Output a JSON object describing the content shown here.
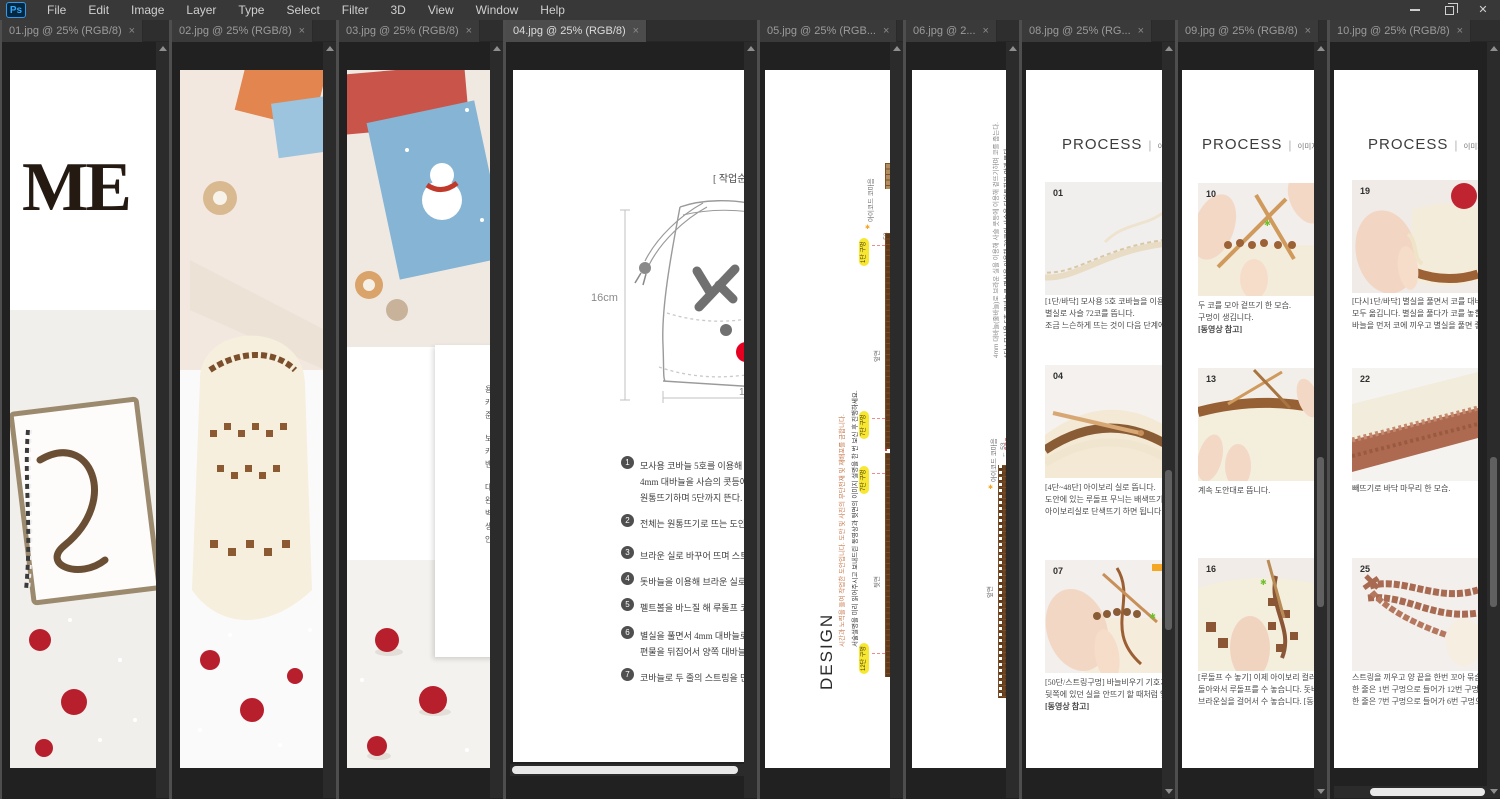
{
  "menubar": {
    "logo": "Ps",
    "items": [
      "File",
      "Edit",
      "Image",
      "Layer",
      "Type",
      "Select",
      "Filter",
      "3D",
      "View",
      "Window",
      "Help"
    ]
  },
  "window_controls": {
    "close": "✕"
  },
  "tabs": {
    "t01": "01.jpg @ 25% (RGB/8)",
    "t02": "02.jpg @ 25% (RGB/8)",
    "t03": "03.jpg @ 25% (RGB/8)",
    "t04": "04.jpg @ 25% (RGB/8)",
    "t05": "05.jpg @ 25% (RGB...",
    "t06": "06.jpg @ 2...",
    "t08": "08.jpg @ 25% (RG...",
    "t09": "09.jpg @ 25% (RGB/8)",
    "t10": "10.jpg @ 25% (RGB/8)",
    "close": "×"
  },
  "pane01": {
    "title": "ME"
  },
  "pane03": {
    "fragments": [
      "용",
      "카드",
      "준비",
      "보기",
      "카드",
      "밴드",
      "대비",
      "완성",
      "벽에",
      "생활",
      "안드"
    ]
  },
  "pane04": {
    "header": "[ 작업순서 ]",
    "dim_h": "16cm",
    "dim_w": "15",
    "steps": [
      {
        "n": "1",
        "lines": [
          "모사용 코바늘 5호를 이용해 별실로 사슬",
          "4mm 대바늘을 사슴의 콧등에 넣어 겉뜨",
          "원통뜨기하며 5단까지 뜬다."
        ]
      },
      {
        "n": "2",
        "lines": [
          "전체는 원통뜨기로 뜨는 도안이며 아이보"
        ]
      },
      {
        "n": "3",
        "lines": [
          "브라운 실로 바꾸어 뜨며 스트링 구멍을"
        ]
      },
      {
        "n": "4",
        "lines": [
          "돗바늘을 이용해 브라운 실로 루돌프 무늬"
        ]
      },
      {
        "n": "5",
        "lines": [
          "펠트볼을 바느질 해 루돌프 코를 완성한"
        ]
      },
      {
        "n": "6",
        "lines": [
          "별실을 풀면서 4mm 대바늘로 코를 옮기고",
          "편물을 뒤집어서 양쪽 대바늘에서 한코"
        ]
      },
      {
        "n": "7",
        "lines": [
          "코바늘로 두 줄의 스트링을 만들어 끼우"
        ]
      }
    ]
  },
  "pane05": {
    "design": "DESIGN",
    "note_black": "서술설명을 미리 읽어주시고 보내드린 동영상과 뒷면의 이미지 설명을 한 번 보신 후 진행하세요.",
    "note_orange": "시간과 노력을 들여 작업한 도안입니다. 도안 및 사진의 무단전재 및 재배포를 금합니다.",
    "front": "앞면",
    "back": "뒷면",
    "icord": "아이코드 코마음",
    "count": "← 53",
    "star": "✱",
    "pills": [
      "1단 구멍",
      "7단 구멍",
      "7단 구멍",
      "12단 구멍"
    ]
  },
  "pane06": {
    "line1": "1단 | 모사용 5호 코바늘로 별실을 이용해 72코의 사슬을 타이트하지 않게 뜬다.",
    "line2": "4mm 대바늘(줄바늘)로 브라운 실을 이용해 사슬 콧등에 이용해 겉뜨기하며 코를 줍는다.",
    "icord": "아이코드 코마음",
    "count": "← 53",
    "star": "✱",
    "front": "앞면"
  },
  "pane08": {
    "heading": "PROCESS",
    "sep": "|",
    "sub": "이미지 과",
    "items": [
      {
        "num": "01",
        "lines": [
          "[1단/바닥] 모사용 5호 코바늘을 이용해",
          "별실로 사슬 72코를 뜹니다.",
          "조금 느슨하게 뜨는 것이 다음 단계에서"
        ]
      },
      {
        "num": "04",
        "lines": [
          "[4단~48단] 아이보리 실로 뜹니다.",
          "도안에 있는 루돌프 무늬는 배색뜨기로",
          "아이보리실로 단색뜨기 하면 됩니다."
        ]
      },
      {
        "num": "07",
        "lines": [
          "[50단/스트링구멍] 바늘비우기 기호가",
          "뒷쪽에 있던 실을 안뜨기 할 때처럼 앞",
          "[동영상 참고]"
        ]
      }
    ]
  },
  "pane09": {
    "heading": "PROCESS",
    "sep": "|",
    "sub": "이미지 과정설명",
    "items": [
      {
        "num": "10",
        "lines": [
          "두 코를 모아 겉뜨기 한 모습.",
          "구멍이 생깁니다.",
          "[동영상 참고]"
        ]
      },
      {
        "num": "13",
        "lines": [
          "계속 도안대로 뜹니다."
        ]
      },
      {
        "num": "16",
        "lines": [
          "[루돌프 수 놓기] 이제 아이보리 컬러 구간으로",
          "돌아와서 루돌프를 수 놓습니다. 돗바늘에",
          "브라운실을 걸어서 수 놓습니다. [동영상 참고]"
        ]
      }
    ]
  },
  "pane10": {
    "heading": "PROCESS",
    "sep": "|",
    "sub": "이미지 과정설명",
    "items": [
      {
        "num": "19",
        "lines": [
          "[다시1단/바닥] 별실을 풀면서 코를 대바늘로",
          "모두 옮깁니다. 별실을 풀다가 코를 놓칠 수 있으",
          "바늘을 먼저 코에 끼우고 별실을 풀면 좋습니다."
        ]
      },
      {
        "num": "22",
        "lines": [
          "빼뜨기로 바닥 마무리 한 모습."
        ]
      },
      {
        "num": "25",
        "lines": [
          "스트링을 끼우고 양 끝을 한번 꼬아 묶습니다.",
          "한 줄은 1번 구멍으로 들어가 12번 구멍으로 나",
          "한 줄은 7번 구멍으로 들어가 6번 구멍으로 나옵"
        ]
      }
    ]
  }
}
